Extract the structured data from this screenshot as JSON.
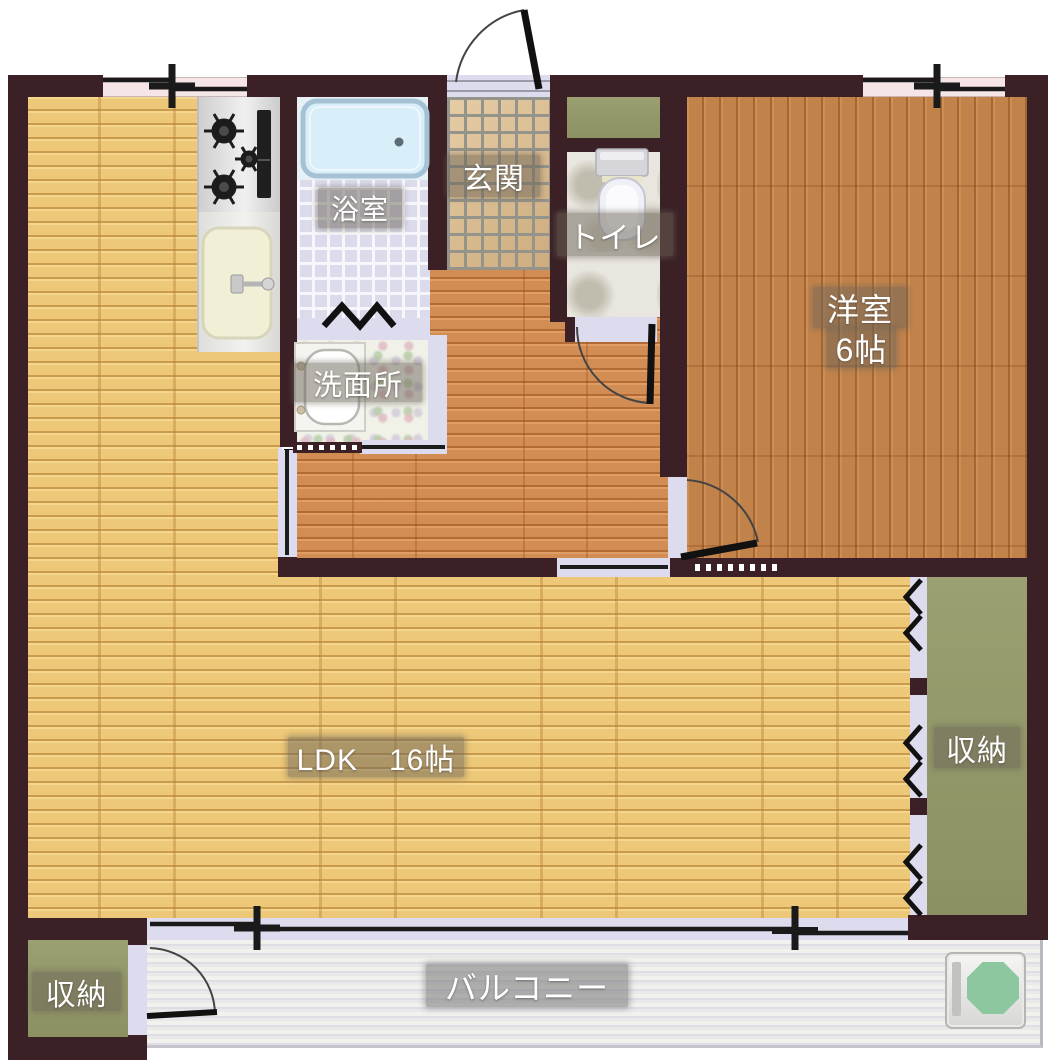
{
  "type": "japanese-apartment-floor-plan",
  "rooms": {
    "ldk": {
      "label": "LDK　16帖"
    },
    "western_room": {
      "label": "洋室",
      "size_label": "6帖"
    },
    "bathroom": {
      "label": "浴室"
    },
    "entrance": {
      "label": "玄関"
    },
    "toilet": {
      "label": "トイレ"
    },
    "washroom": {
      "label": "洗面所"
    },
    "storage_right": {
      "label": "収納"
    },
    "storage_bottom": {
      "label": "収納"
    },
    "balcony": {
      "label": "バルコニー"
    }
  },
  "colors": {
    "wall": "#3b2125",
    "ldk_floor": "#ecc878",
    "hall_floor": "#d28d55",
    "western_floor": "#c2834a",
    "storage_green": "#939768",
    "door_lavender": "#dcdcee",
    "window_pink": "#f6e5e7",
    "bathtub_blue": "#d8eef9",
    "entrance_tile": "#d7b88e",
    "bath_tile": "#dcdbec",
    "balcony_deck": "#e8e8e8",
    "ac_pad_green": "#8cc7a0"
  },
  "fixtures": [
    "bathtub",
    "gas-stove",
    "kitchen-sink",
    "toilet",
    "washbasin",
    "shoe-cabinet",
    "ac-outdoor-unit"
  ]
}
